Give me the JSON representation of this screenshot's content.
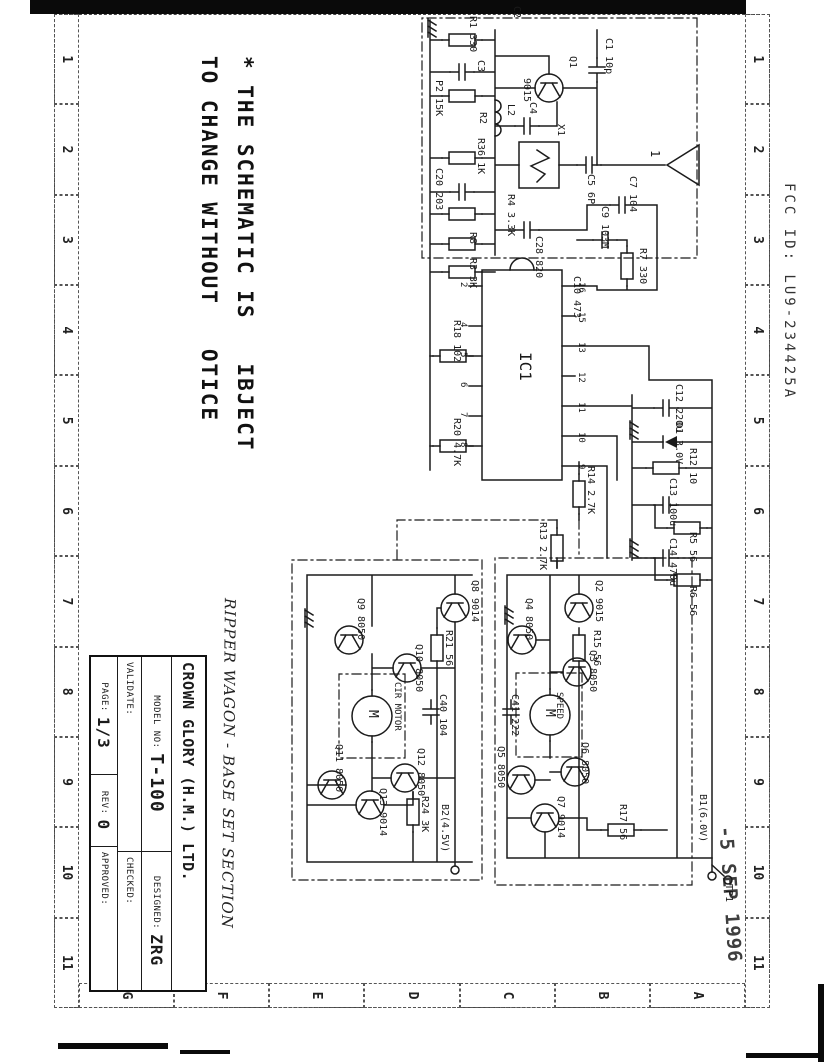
{
  "document": {
    "fcc_id": "FCC ID: LU9-234425A",
    "stamp": "-5 SEP 1996",
    "note_handwritten": "RIPPER WAGON - BASE SET SECTION",
    "disclaimer_line1": "* THE SCHEMATIC IS   IBJECT",
    "disclaimer_line2": "TO CHANGE WITHOUT   OTICE"
  },
  "colors": {
    "ink": "#1b1b1b",
    "paper": "#ffffff"
  },
  "frame": {
    "columns": [
      "1",
      "2",
      "3",
      "4",
      "5",
      "6",
      "7",
      "8",
      "9",
      "10",
      "11"
    ],
    "rows": [
      "A",
      "B",
      "C",
      "D",
      "E",
      "F",
      "G"
    ]
  },
  "title_block": {
    "company": "CROWN GLORY (H.M.) LTD.",
    "model_label": "MODEL NO:",
    "model_value": "T-100",
    "designed_label": "DESIGNED:",
    "designed_value": "ZRG",
    "validate_label": "VALIDATE:",
    "checked_label": "CHECKED:",
    "page_label": "PAGE:",
    "page_value": "1/3",
    "rev_label": "REV:",
    "rev_value": "0",
    "approved_label": "APPROVED:"
  },
  "schematic": {
    "labels": [
      {
        "t": "C2",
        "x": 6,
        "y": 306
      },
      {
        "t": "R1 330",
        "x": 16,
        "y": 350
      },
      {
        "t": "C3",
        "x": 60,
        "y": 342
      },
      {
        "t": "P2 15K",
        "x": 80,
        "y": 384
      },
      {
        "t": "R2",
        "x": 112,
        "y": 340
      },
      {
        "t": "R36 1K",
        "x": 138,
        "y": 342
      },
      {
        "t": "C20 203",
        "x": 168,
        "y": 384
      },
      {
        "t": "L2",
        "x": 104,
        "y": 312
      },
      {
        "t": "C4",
        "x": 102,
        "y": 290
      },
      {
        "t": "Q1",
        "x": 56,
        "y": 250
      },
      {
        "t": "9015",
        "x": 78,
        "y": 296
      },
      {
        "t": "C1 10p",
        "x": 38,
        "y": 214
      },
      {
        "t": "X1",
        "x": 124,
        "y": 262
      },
      {
        "t": "C5 6P",
        "x": 174,
        "y": 232
      },
      {
        "t": "1",
        "x": 150,
        "y": 166,
        "fs": 12
      },
      {
        "t": "R4 3.3K",
        "x": 194,
        "y": 312
      },
      {
        "t": "C28 820",
        "x": 236,
        "y": 284
      },
      {
        "t": "R8",
        "x": 232,
        "y": 350
      },
      {
        "t": "R3 3K",
        "x": 258,
        "y": 350
      },
      {
        "t": "C7 104",
        "x": 176,
        "y": 190
      },
      {
        "t": "R7 330",
        "x": 248,
        "y": 180
      },
      {
        "t": "C9 103M",
        "x": 206,
        "y": 218
      },
      {
        "t": "C10 473",
        "x": 276,
        "y": 246
      },
      {
        "t": "IC1",
        "x": 352,
        "y": 294,
        "fs": 16
      },
      {
        "t": "R18 102",
        "x": 320,
        "y": 366
      },
      {
        "t": "R20 4.7K",
        "x": 418,
        "y": 366
      },
      {
        "t": "R14 2.7K",
        "x": 466,
        "y": 232
      },
      {
        "t": "R13 2.7K",
        "x": 522,
        "y": 280
      },
      {
        "t": "C12 220u",
        "x": 384,
        "y": 144
      },
      {
        "t": "D1 3.0V",
        "x": 422,
        "y": 144
      },
      {
        "t": "R12 10",
        "x": 448,
        "y": 130
      },
      {
        "t": "C13 100u",
        "x": 478,
        "y": 150
      },
      {
        "t": "R5 56",
        "x": 532,
        "y": 130
      },
      {
        "t": "C14 470u",
        "x": 538,
        "y": 150
      },
      {
        "t": "R6 56",
        "x": 586,
        "y": 130
      },
      {
        "t": "16",
        "x": 282,
        "y": 242,
        "fs": 9
      },
      {
        "t": "15",
        "x": 312,
        "y": 242,
        "fs": 9
      },
      {
        "t": "13",
        "x": 342,
        "y": 242,
        "fs": 9
      },
      {
        "t": "12",
        "x": 372,
        "y": 242,
        "fs": 9
      },
      {
        "t": "11",
        "x": 402,
        "y": 242,
        "fs": 9
      },
      {
        "t": "10",
        "x": 432,
        "y": 242,
        "fs": 9
      },
      {
        "t": "9",
        "x": 464,
        "y": 242,
        "fs": 9
      },
      {
        "t": "2",
        "x": 282,
        "y": 360,
        "fs": 9
      },
      {
        "t": "4",
        "x": 322,
        "y": 360,
        "fs": 9
      },
      {
        "t": "5",
        "x": 352,
        "y": 360,
        "fs": 9
      },
      {
        "t": "6",
        "x": 382,
        "y": 360,
        "fs": 9
      },
      {
        "t": "7",
        "x": 412,
        "y": 360,
        "fs": 9
      },
      {
        "t": "8",
        "x": 442,
        "y": 360,
        "fs": 9
      },
      {
        "t": "Q8 9014",
        "x": 580,
        "y": 348
      },
      {
        "t": "R21 56",
        "x": 630,
        "y": 374
      },
      {
        "t": "Q9 8050",
        "x": 598,
        "y": 462
      },
      {
        "t": "Q10 8050",
        "x": 644,
        "y": 404
      },
      {
        "t": "CIR MOTOR",
        "x": 682,
        "y": 426,
        "fs": 9
      },
      {
        "t": "M",
        "x": 710,
        "y": 448,
        "fs": 13
      },
      {
        "t": "C40 104",
        "x": 694,
        "y": 380
      },
      {
        "t": "Q11 8050",
        "x": 744,
        "y": 484
      },
      {
        "t": "Q12 8050",
        "x": 748,
        "y": 402
      },
      {
        "t": "Q13 9014",
        "x": 788,
        "y": 440
      },
      {
        "t": "R24 3K",
        "x": 796,
        "y": 398
      },
      {
        "t": "B2(4.5V)",
        "x": 804,
        "y": 378
      },
      {
        "t": "Q2 9015",
        "x": 580,
        "y": 224
      },
      {
        "t": "R15 56",
        "x": 630,
        "y": 226
      },
      {
        "t": "Q4 8050",
        "x": 598,
        "y": 294
      },
      {
        "t": "Q3 8050",
        "x": 650,
        "y": 230
      },
      {
        "t": "SPEED",
        "x": 692,
        "y": 264,
        "fs": 9
      },
      {
        "t": "M",
        "x": 709,
        "y": 271,
        "fs": 13
      },
      {
        "t": "C41 222",
        "x": 694,
        "y": 308
      },
      {
        "t": "Q5 8050",
        "x": 746,
        "y": 322
      },
      {
        "t": "Q6 8050",
        "x": 742,
        "y": 238
      },
      {
        "t": "Q7 9014",
        "x": 796,
        "y": 262
      },
      {
        "t": "R17 56",
        "x": 804,
        "y": 200
      },
      {
        "t": "B1(6.0V)",
        "x": 794,
        "y": 120
      },
      {
        "t": "TP1",
        "x": 884,
        "y": 94
      }
    ]
  }
}
